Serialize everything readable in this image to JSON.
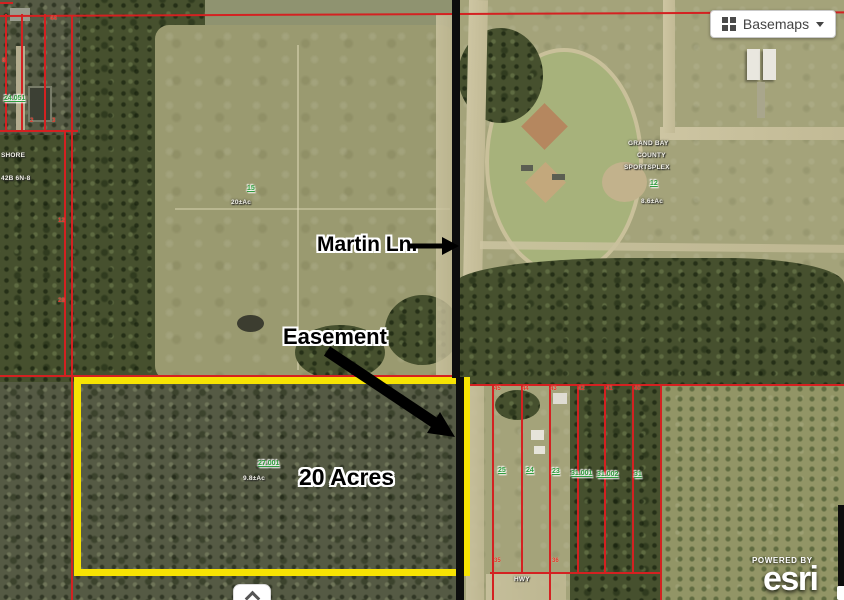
{
  "controls": {
    "basemaps_label": "Basemaps"
  },
  "attribution": {
    "powered_by": "POWERED BY",
    "brand": "esri"
  },
  "annotations": {
    "martin_ln": "Martin Ln.",
    "easement": "Easement",
    "acres": "20 Acres"
  },
  "colors": {
    "parcel_line": "#d42121",
    "highlight_outline": "#f7e303",
    "road_line": "#0d0d0d",
    "parcel_number_green": "#2f9e3f"
  },
  "parcel_labels": [
    {
      "text": "24.051",
      "x": 4,
      "y": 95
    },
    {
      "text": "15",
      "x": 247,
      "y": 185
    },
    {
      "text": "27.001",
      "x": 258,
      "y": 460
    },
    {
      "text": "12",
      "x": 650,
      "y": 180
    },
    {
      "text": "25",
      "x": 498,
      "y": 467
    },
    {
      "text": "24",
      "x": 526,
      "y": 467
    },
    {
      "text": "23",
      "x": 552,
      "y": 468
    },
    {
      "text": "31.001",
      "x": 571,
      "y": 470
    },
    {
      "text": "31.002",
      "x": 597,
      "y": 471
    },
    {
      "text": "31",
      "x": 634,
      "y": 471
    }
  ],
  "area_labels": [
    {
      "text": "20±Ac",
      "x": 231,
      "y": 199
    },
    {
      "text": "9.8±Ac",
      "x": 243,
      "y": 475
    },
    {
      "text": "8.6±Ac",
      "x": 641,
      "y": 198
    },
    {
      "text": "GRAND BAY",
      "x": 628,
      "y": 140
    },
    {
      "text": "COUNTY",
      "x": 637,
      "y": 152
    },
    {
      "text": "SPORTSPLEX",
      "x": 624,
      "y": 164
    },
    {
      "text": "SHORE",
      "x": 1,
      "y": 152
    },
    {
      "text": "42B 6N-8",
      "x": 1,
      "y": 175
    },
    {
      "text": "HWY",
      "x": 514,
      "y": 576
    }
  ],
  "red_numbers": [
    {
      "text": "44",
      "x": 50,
      "y": 16
    },
    {
      "text": "8",
      "x": 2,
      "y": 58
    },
    {
      "text": "2",
      "x": 30,
      "y": 118
    },
    {
      "text": "3",
      "x": 52,
      "y": 118
    },
    {
      "text": "12",
      "x": 58,
      "y": 218
    },
    {
      "text": "28",
      "x": 58,
      "y": 298
    },
    {
      "text": "45",
      "x": 494,
      "y": 386
    },
    {
      "text": "44",
      "x": 522,
      "y": 386
    },
    {
      "text": "43",
      "x": 550,
      "y": 386
    },
    {
      "text": "42",
      "x": 578,
      "y": 386
    },
    {
      "text": "41",
      "x": 606,
      "y": 386
    },
    {
      "text": "40",
      "x": 634,
      "y": 386
    },
    {
      "text": "35",
      "x": 494,
      "y": 558
    },
    {
      "text": "36",
      "x": 552,
      "y": 558
    }
  ]
}
